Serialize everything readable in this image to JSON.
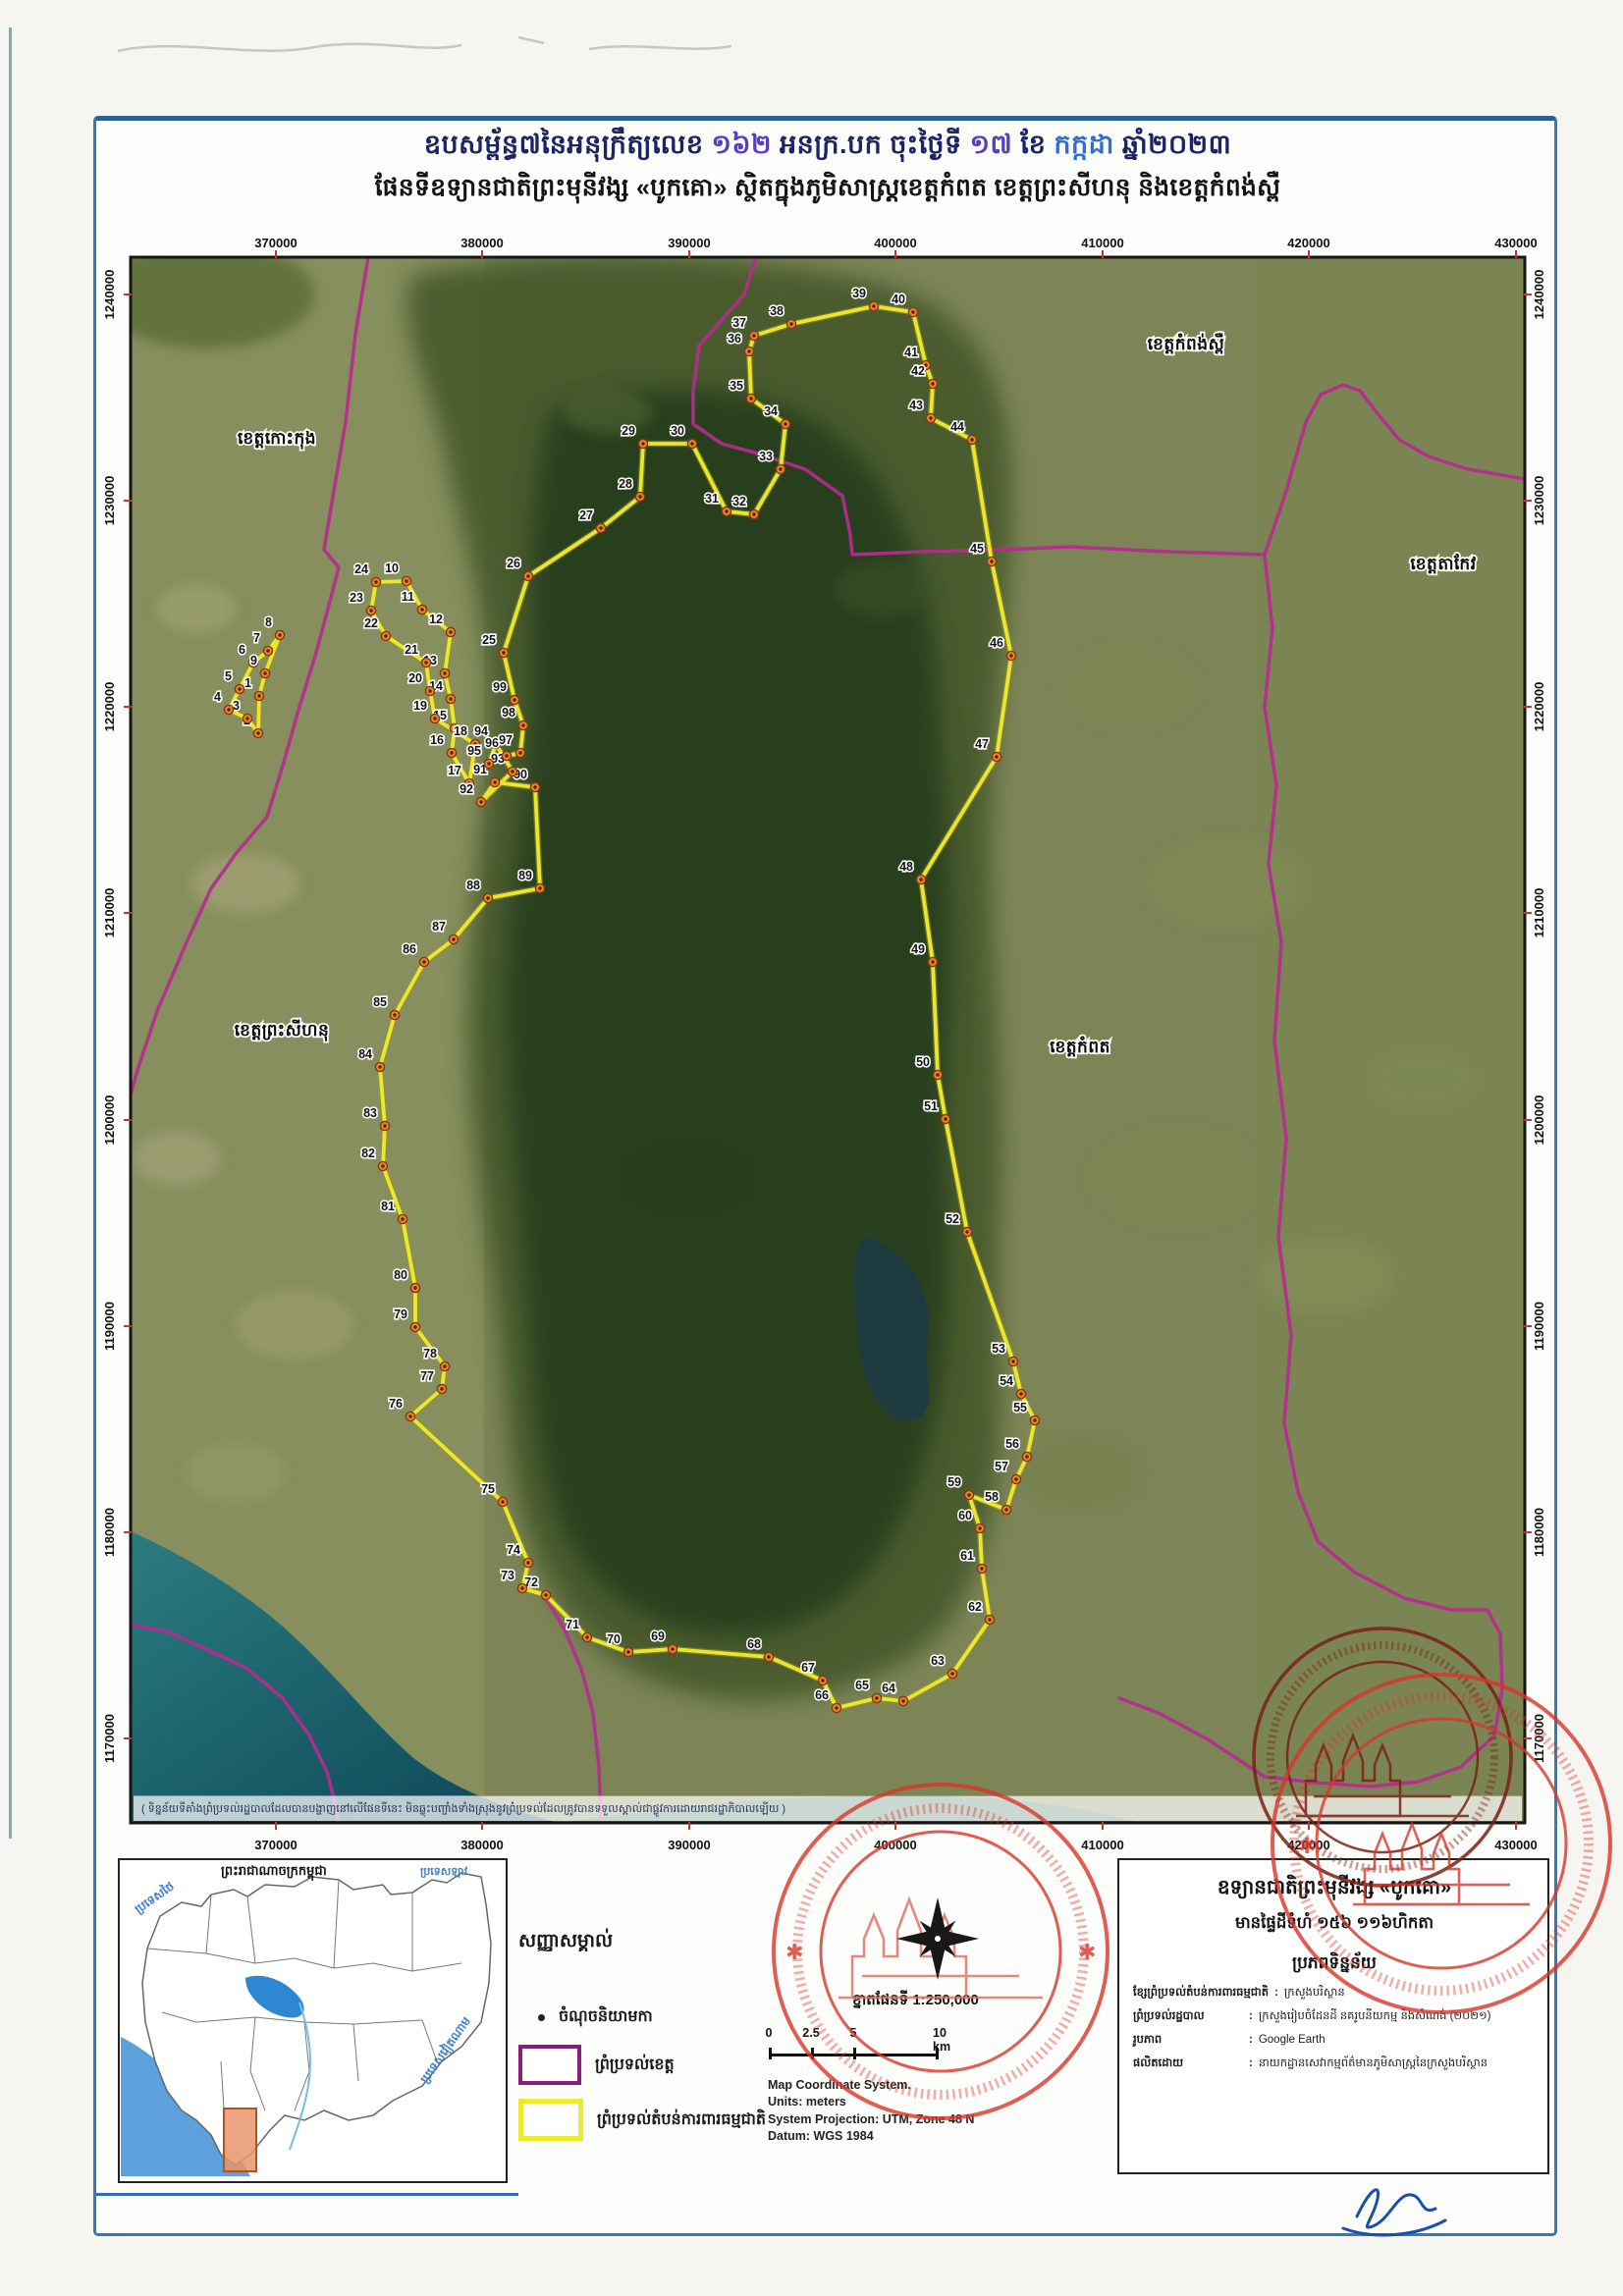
{
  "title": {
    "line1_segments": [
      {
        "text": "ឧបសម្ព័ន្ធ៧នៃអនុក្រឹត្យលេខ ",
        "color": "#1c2563"
      },
      {
        "text": "១៦២",
        "color": "#5a3ec2"
      },
      {
        "text": "  អនក្រ.បក ចុះថ្ងៃទី ",
        "color": "#1c2563"
      },
      {
        "text": "១៧",
        "color": "#5a3ec2"
      },
      {
        "text": " ខែ ",
        "color": "#1c2563"
      },
      {
        "text": "កក្កដា",
        "color": "#2f6fd0"
      },
      {
        "text": "  ឆ្នាំ២០២៣",
        "color": "#1c2563"
      }
    ],
    "line2": "ផែនទីឧទ្យានជាតិព្រះមុនីវង្ស «បូកគោ» ស្ថិតក្នុងភូមិសាស្ត្រខេត្តកំពត ខេត្តព្រះសីហនុ និងខេត្តកំពង់ស្ពឺ"
  },
  "map": {
    "x_ticks": [
      [
        "370000",
        281
      ],
      [
        "380000",
        491
      ],
      [
        "390000",
        702
      ],
      [
        "400000",
        912
      ],
      [
        "410000",
        1123
      ],
      [
        "420000",
        1333
      ],
      [
        "430000",
        1544
      ]
    ],
    "y_ticks": [
      [
        "1240000",
        300
      ],
      [
        "1230000",
        510
      ],
      [
        "1220000",
        720
      ],
      [
        "1210000",
        930
      ],
      [
        "1200000",
        1141
      ],
      [
        "1190000",
        1351
      ],
      [
        "1180000",
        1561
      ],
      [
        "1170000",
        1771
      ]
    ],
    "region_labels": [
      {
        "text": "ខេត្តកោះកុង",
        "x": 282,
        "y": 452
      },
      {
        "text": "ខេត្តកំពង់ស្ពឺ",
        "x": 1208,
        "y": 356
      },
      {
        "text": "ខេត្តតាកែវ",
        "x": 1470,
        "y": 580
      },
      {
        "text": "ខេត្តព្រះសីហនុ",
        "x": 287,
        "y": 1055
      },
      {
        "text": "ខេត្តកំពត",
        "x": 1100,
        "y": 1072
      }
    ],
    "disclaimer": "( ទិន្នន័យទីតាំងព្រំប្រទល់រដ្ឋបាលដែលបានបង្ហាញនៅលើផែនទីនេះ មិនឆ្លុះបញ្ចាំងទាំងស្រុងនូវព្រំប្រទល់ដែលត្រូវបានទទួលស្គាល់ជាផ្លូវការដោយរាជរដ្ឋាភិបាលឡើយ )",
    "colors": {
      "province_boundary": "#b62a90",
      "protected_boundary": "#efe92f",
      "point_fill": "#e08a2e",
      "stamp_red": "#d8352a",
      "stamp_maroon": "#8a2418",
      "frame_blue": "#3579b8"
    },
    "points": [
      [
        1,
        264,
        709
      ],
      [
        2,
        263,
        747
      ],
      [
        3,
        252,
        732
      ],
      [
        4,
        233,
        723
      ],
      [
        5,
        244,
        702
      ],
      [
        6,
        258,
        675
      ],
      [
        7,
        273,
        663
      ],
      [
        8,
        285,
        647
      ],
      [
        9,
        270,
        686
      ],
      [
        10,
        414,
        592
      ],
      [
        11,
        430,
        621
      ],
      [
        12,
        459,
        644
      ],
      [
        13,
        453,
        686
      ],
      [
        14,
        459,
        712
      ],
      [
        15,
        463,
        742
      ],
      [
        16,
        460,
        767
      ],
      [
        17,
        478,
        798
      ],
      [
        18,
        484,
        758
      ],
      [
        19,
        443,
        732
      ],
      [
        20,
        438,
        704
      ],
      [
        21,
        434,
        675
      ],
      [
        22,
        393,
        648
      ],
      [
        23,
        378,
        622
      ],
      [
        24,
        383,
        593
      ],
      [
        25,
        513,
        665
      ],
      [
        26,
        538,
        587
      ],
      [
        27,
        612,
        538
      ],
      [
        28,
        652,
        506
      ],
      [
        29,
        655,
        452
      ],
      [
        30,
        705,
        452
      ],
      [
        31,
        740,
        521
      ],
      [
        32,
        768,
        524
      ],
      [
        33,
        795,
        478
      ],
      [
        34,
        800,
        432
      ],
      [
        35,
        765,
        406
      ],
      [
        36,
        763,
        358
      ],
      [
        37,
        768,
        342
      ],
      [
        38,
        806,
        330
      ],
      [
        39,
        890,
        312
      ],
      [
        40,
        930,
        318
      ],
      [
        41,
        943,
        372
      ],
      [
        42,
        950,
        391
      ],
      [
        43,
        948,
        426
      ],
      [
        44,
        990,
        448
      ],
      [
        45,
        1010,
        572
      ],
      [
        46,
        1030,
        668
      ],
      [
        47,
        1015,
        771
      ],
      [
        48,
        938,
        896
      ],
      [
        49,
        950,
        980
      ],
      [
        50,
        955,
        1095
      ],
      [
        51,
        963,
        1140
      ],
      [
        52,
        985,
        1255
      ],
      [
        53,
        1032,
        1387
      ],
      [
        54,
        1040,
        1420
      ],
      [
        55,
        1054,
        1447
      ],
      [
        56,
        1046,
        1484
      ],
      [
        57,
        1035,
        1507
      ],
      [
        58,
        1025,
        1538
      ],
      [
        59,
        987,
        1523
      ],
      [
        60,
        998,
        1557
      ],
      [
        61,
        1000,
        1598
      ],
      [
        62,
        1008,
        1650
      ],
      [
        63,
        970,
        1705
      ],
      [
        64,
        920,
        1733
      ],
      [
        65,
        893,
        1730
      ],
      [
        66,
        852,
        1740
      ],
      [
        67,
        838,
        1712
      ],
      [
        68,
        783,
        1688
      ],
      [
        69,
        685,
        1680
      ],
      [
        70,
        640,
        1683
      ],
      [
        71,
        598,
        1668
      ],
      [
        72,
        556,
        1625
      ],
      [
        73,
        532,
        1618
      ],
      [
        74,
        538,
        1592
      ],
      [
        75,
        512,
        1530
      ],
      [
        76,
        418,
        1443
      ],
      [
        77,
        450,
        1415
      ],
      [
        78,
        453,
        1392
      ],
      [
        79,
        423,
        1352
      ],
      [
        80,
        423,
        1312
      ],
      [
        81,
        410,
        1242
      ],
      [
        82,
        390,
        1188
      ],
      [
        83,
        392,
        1147
      ],
      [
        84,
        387,
        1087
      ],
      [
        85,
        402,
        1034
      ],
      [
        86,
        432,
        980
      ],
      [
        87,
        462,
        957
      ],
      [
        88,
        497,
        915
      ],
      [
        89,
        550,
        905
      ],
      [
        90,
        545,
        802
      ],
      [
        91,
        504,
        797
      ],
      [
        92,
        490,
        817
      ],
      [
        93,
        522,
        786
      ],
      [
        94,
        505,
        758
      ],
      [
        95,
        498,
        778
      ],
      [
        96,
        516,
        770
      ],
      [
        97,
        530,
        767
      ],
      [
        98,
        533,
        739
      ],
      [
        99,
        524,
        713
      ]
    ],
    "boundary_loops": [
      [
        1,
        2,
        3,
        4,
        5,
        6,
        7,
        8,
        9
      ],
      [
        10,
        11,
        12,
        13,
        14,
        15,
        16,
        17,
        18,
        19,
        20,
        21,
        22,
        23,
        24
      ],
      [
        25,
        26,
        27,
        28,
        29,
        30,
        31,
        32,
        33,
        34,
        35,
        36,
        37,
        38,
        39,
        40,
        41,
        42,
        43,
        44,
        45,
        46,
        47,
        48,
        49,
        50,
        51,
        52,
        53,
        54,
        55,
        56,
        57,
        58,
        59,
        60,
        61,
        62,
        63,
        64,
        65,
        66,
        67,
        68,
        69,
        70,
        71,
        72,
        73,
        74,
        75,
        76,
        77,
        78,
        79,
        80,
        81,
        82,
        83,
        84,
        85,
        86,
        87,
        88,
        89,
        90,
        91,
        92,
        93,
        94,
        95,
        96,
        97,
        98,
        99
      ]
    ],
    "province_boundaries": [
      [
        [
          375,
          262
        ],
        [
          362,
          340
        ],
        [
          352,
          430
        ],
        [
          340,
          500
        ],
        [
          330,
          560
        ],
        [
          345,
          578
        ],
        [
          338,
          605
        ],
        [
          322,
          665
        ],
        [
          305,
          720
        ],
        [
          288,
          780
        ],
        [
          272,
          832
        ],
        [
          240,
          870
        ],
        [
          215,
          905
        ],
        [
          190,
          960
        ],
        [
          160,
          1030
        ],
        [
          140,
          1090
        ],
        [
          133,
          1115
        ]
      ],
      [
        [
          770,
          262
        ],
        [
          758,
          300
        ],
        [
          712,
          352
        ],
        [
          706,
          398
        ],
        [
          706,
          432
        ],
        [
          735,
          452
        ],
        [
          772,
          462
        ],
        [
          820,
          478
        ],
        [
          858,
          505
        ],
        [
          866,
          545
        ],
        [
          868,
          565
        ],
        [
          940,
          562
        ],
        [
          1020,
          560
        ],
        [
          1090,
          557
        ],
        [
          1190,
          562
        ],
        [
          1288,
          565
        ]
      ],
      [
        [
          1288,
          565
        ],
        [
          1310,
          500
        ],
        [
          1330,
          430
        ],
        [
          1345,
          402
        ],
        [
          1368,
          392
        ],
        [
          1385,
          398
        ],
        [
          1402,
          420
        ],
        [
          1425,
          448
        ],
        [
          1455,
          465
        ],
        [
          1495,
          478
        ],
        [
          1530,
          484
        ],
        [
          1553,
          488
        ]
      ],
      [
        [
          1288,
          565
        ],
        [
          1296,
          640
        ],
        [
          1288,
          720
        ],
        [
          1300,
          800
        ],
        [
          1292,
          880
        ],
        [
          1305,
          960
        ],
        [
          1298,
          1060
        ],
        [
          1310,
          1160
        ],
        [
          1302,
          1260
        ],
        [
          1315,
          1360
        ],
        [
          1308,
          1450
        ],
        [
          1322,
          1520
        ],
        [
          1342,
          1570
        ],
        [
          1380,
          1602
        ],
        [
          1430,
          1628
        ],
        [
          1478,
          1640
        ],
        [
          1515,
          1640
        ],
        [
          1528,
          1665
        ],
        [
          1530,
          1720
        ],
        [
          1522,
          1768
        ],
        [
          1488,
          1800
        ],
        [
          1445,
          1815
        ],
        [
          1395,
          1820
        ],
        [
          1340,
          1816
        ],
        [
          1288,
          1810
        ],
        [
          1230,
          1772
        ],
        [
          1180,
          1745
        ],
        [
          1140,
          1730
        ]
      ],
      [
        [
          133,
          1655
        ],
        [
          170,
          1662
        ],
        [
          210,
          1680
        ],
        [
          252,
          1700
        ],
        [
          288,
          1730
        ],
        [
          315,
          1768
        ],
        [
          333,
          1805
        ],
        [
          342,
          1840
        ],
        [
          345,
          1857
        ]
      ],
      [
        [
          556,
          1628
        ],
        [
          575,
          1660
        ],
        [
          592,
          1700
        ],
        [
          604,
          1745
        ],
        [
          610,
          1800
        ],
        [
          612,
          1857
        ]
      ]
    ]
  },
  "inset": {
    "title": "ព្រះរាជាណាចក្រកម្ពុជា",
    "thailand": "ប្រទេសថៃ",
    "laos": "ប្រទេសឡាវ",
    "vietnam": "ប្រទេសវៀតណាម"
  },
  "legend": {
    "header": "សញ្ញាសម្គាល់",
    "items": [
      {
        "label": "ចំណុចនិយាមកា",
        "symbol": "survey-point"
      },
      {
        "label": "ព្រំប្រទល់ខេត្ត",
        "symbol": "province-boundary"
      },
      {
        "label": "ព្រំប្រទល់តំបន់ការពារធម្មជាតិ",
        "symbol": "protected-area-boundary"
      }
    ]
  },
  "scale": {
    "label_khmer": "ខ្នាតផែនទី",
    "label_ratio": "1:250,000",
    "bar": [
      "0",
      "2.5",
      "5",
      "10 km"
    ],
    "meta": [
      "Map Coordinate System.",
      "Units: meters",
      "System Projection: UTM, Zone 48 N",
      "Datum: WGS 1984"
    ]
  },
  "info_box": {
    "title": "ឧទ្យានជាតិព្រះមុនីវង្ស «បូកគោ»",
    "area": "មានផ្ទៃដីទំហំ ១៥៦ ១១៦ហិកតា",
    "source_header": "ប្រភពទិន្នន័យ",
    "rows": [
      {
        "label": "ខ្សែព្រំប្រទល់តំបន់ការពារធម្មជាតិ",
        "value": "ក្រសួងបរិស្ថាន"
      },
      {
        "label": "ព្រំប្រទល់រដ្ឋបាល",
        "value": "ក្រសួងរៀបចំដែនដី នគរូបនីយកម្ម និងសំណង់ (២០២១)"
      },
      {
        "label": "រូបភាព",
        "value": "Google Earth"
      },
      {
        "label": "ផលិតដោយ",
        "value": "នាយកដ្ឋានសេវាកម្មព័ត៌មានភូមិសាស្ត្រនៃក្រសួងបរិស្ថាន"
      }
    ]
  }
}
